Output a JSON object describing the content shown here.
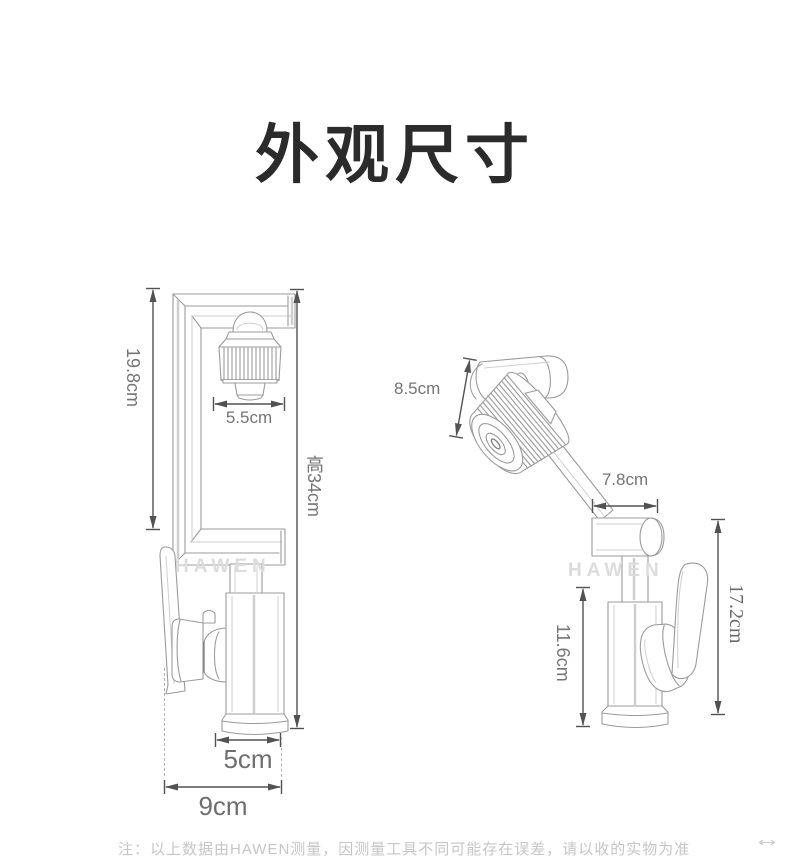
{
  "page": {
    "title": "外观尺寸"
  },
  "brand_watermark": "HAWEN",
  "left_view": {
    "description": "faucet-front-view-sketch",
    "dimensions": {
      "arm_height": "19.8cm",
      "spray_head_width": "5.5cm",
      "total_height": "高34cm",
      "base_width": "5cm",
      "total_width": "9cm"
    }
  },
  "right_view": {
    "description": "faucet-rotated-view-sketch",
    "dimensions": {
      "spray_head_length": "8.5cm",
      "swivel_arm_length": "7.8cm",
      "body_height": "11.6cm",
      "total_height": "17.2cm"
    }
  },
  "footnote": "注：以上数据由HAWEN测量，因测量工具不同可能存在误差，请以收的实物为准",
  "scroll_hint_icon": "↔",
  "colors": {
    "background": "#ffffff",
    "title_text": "#2b2b2b",
    "dimension_arrow": "#525252",
    "dimension_label": "#757575",
    "sketch_line": "#9b9b9b",
    "watermark_text": "#dcdcdc",
    "footnote_text": "#c6c6c6"
  }
}
